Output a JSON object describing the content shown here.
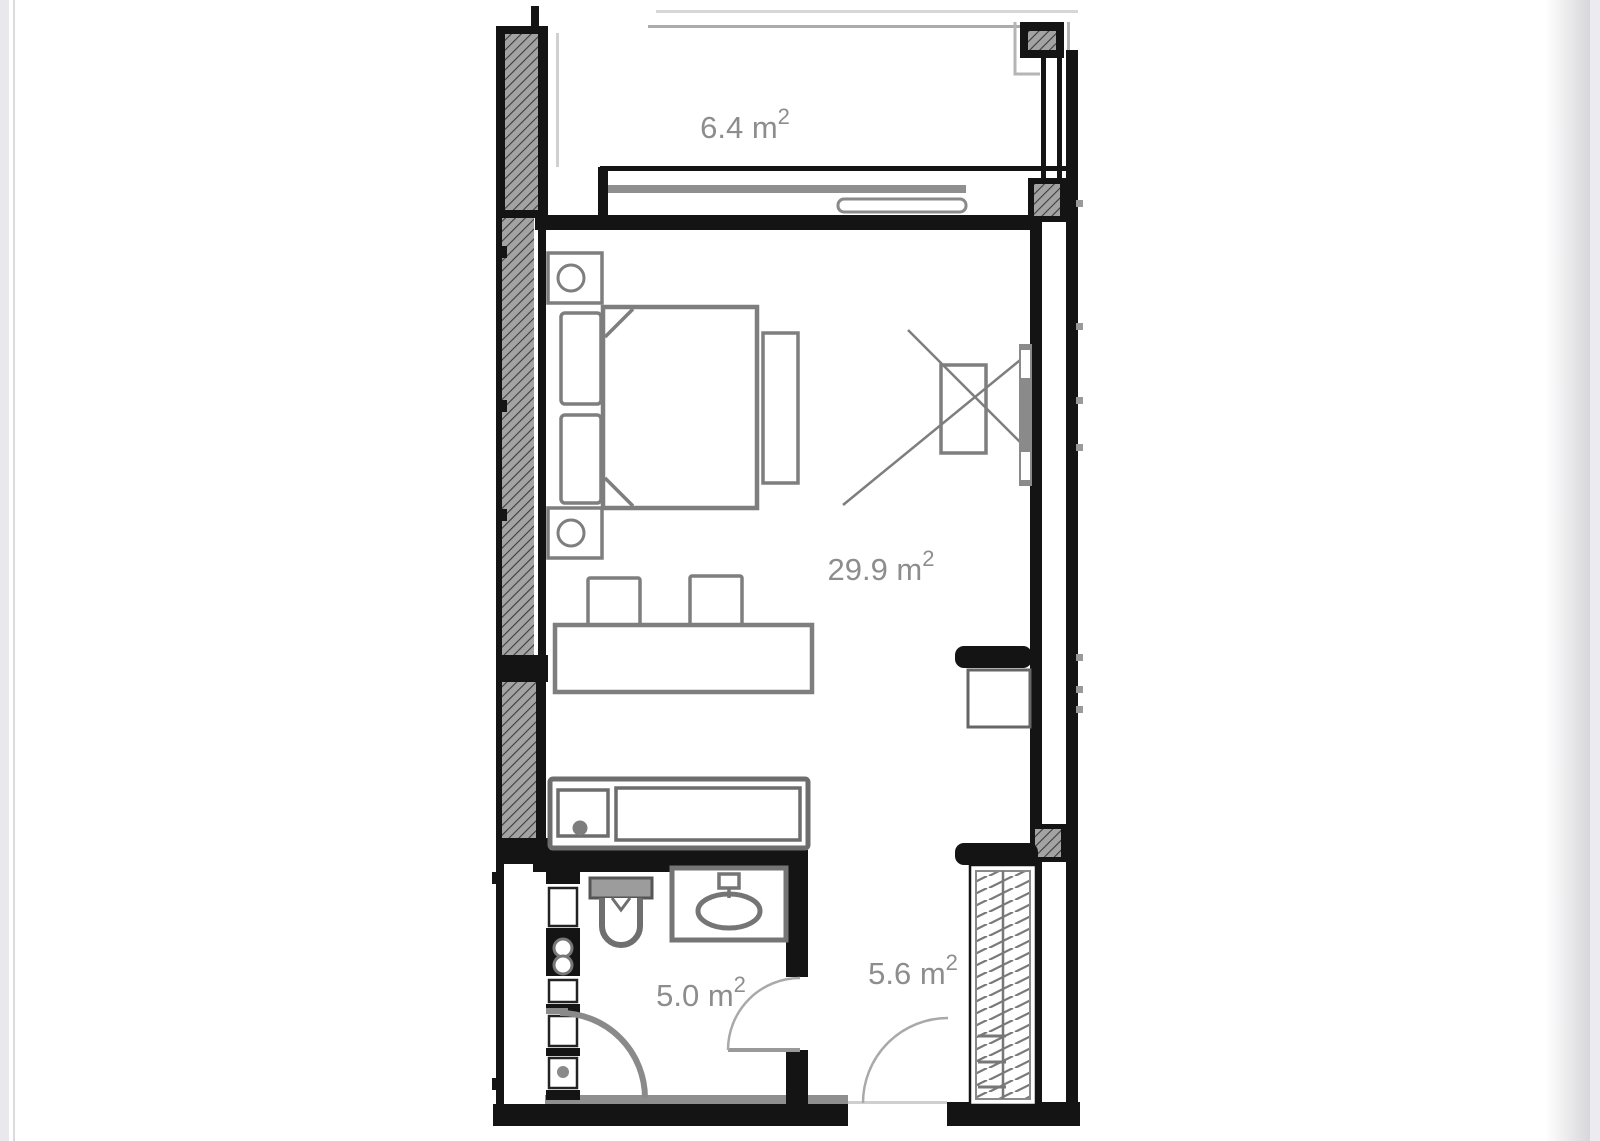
{
  "page": {
    "background": "#ffffff",
    "left_edge_color": "#e9e9ed",
    "right_edge_color": "#ececf0"
  },
  "floor_plan": {
    "type": "studio apartment floor plan",
    "rooms": [
      {
        "id": "balcony",
        "area_label": "6.4 m",
        "area_exponent": "2"
      },
      {
        "id": "living-room",
        "area_label": "29.9 m",
        "area_exponent": "2"
      },
      {
        "id": "bathroom",
        "area_label": "5.0 m",
        "area_exponent": "2"
      },
      {
        "id": "hallway",
        "area_label": "5.6 m",
        "area_exponent": "2"
      }
    ],
    "colors": {
      "wall": "#141414",
      "furniture": "#7e7e7e",
      "label": "#8d8d8d",
      "hatch": "#a3a3a3"
    }
  }
}
